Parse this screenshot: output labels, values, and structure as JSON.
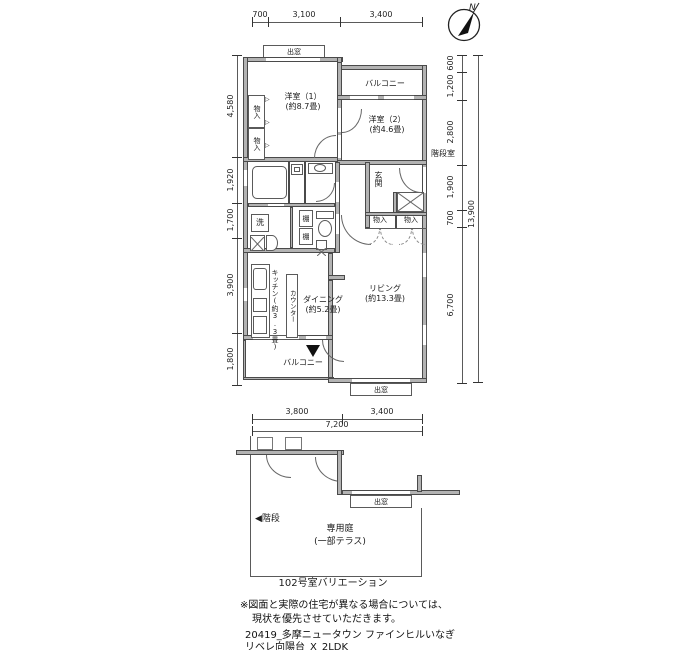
{
  "compass": {
    "label": "N"
  },
  "dimensions": {
    "top": [
      "700",
      "3,100",
      "3,400"
    ],
    "left": [
      "4,580",
      "1,920",
      "1,700",
      "3,900",
      "1,800"
    ],
    "right": [
      "600",
      "1,200",
      "2,800",
      "1,900",
      "700",
      "6,700"
    ],
    "right_overall": "13,900",
    "lower_top": [
      "3,800",
      "3,400"
    ],
    "lower_overall": "7,200"
  },
  "main_plan": {
    "bay_window_top": "出窓",
    "bedroom1": "洋室（1）",
    "bedroom1_area": "(約8.7畳)",
    "bedroom2": "洋室（2）",
    "bedroom2_area": "(約4.6畳)",
    "balcony_upper": "バルコニー",
    "stairwell": "階段室",
    "entrance": "玄関",
    "closet": "物入",
    "closet_mark": "▷",
    "laundry": "洗",
    "shelf": "棚",
    "kitchen": "キッチン(約3.3畳)",
    "counter": "カウンター",
    "dining": "ダイニング",
    "dining_area": "(約5.2畳)",
    "living": "リビング",
    "living_area": "(約13.3畳)",
    "balcony_lower": "バルコニー",
    "bay_window_bottom": "出窓"
  },
  "variation_plan": {
    "stairs_arrow": "◀",
    "stairs": "階段",
    "garden": "専用庭",
    "garden_note": "(一部テラス)",
    "bay_window": "出窓",
    "caption": "102号室バリエーション"
  },
  "notes": {
    "disclaimer_line1": "※図面と実際の住宅が異なる場合については、",
    "disclaimer_line2": "現状を優先させていただきます。",
    "project_line1": "20419_多摩ニュータウン ファインヒルいなぎ",
    "project_line2": "リベレ向陽台_X_2LDK"
  }
}
